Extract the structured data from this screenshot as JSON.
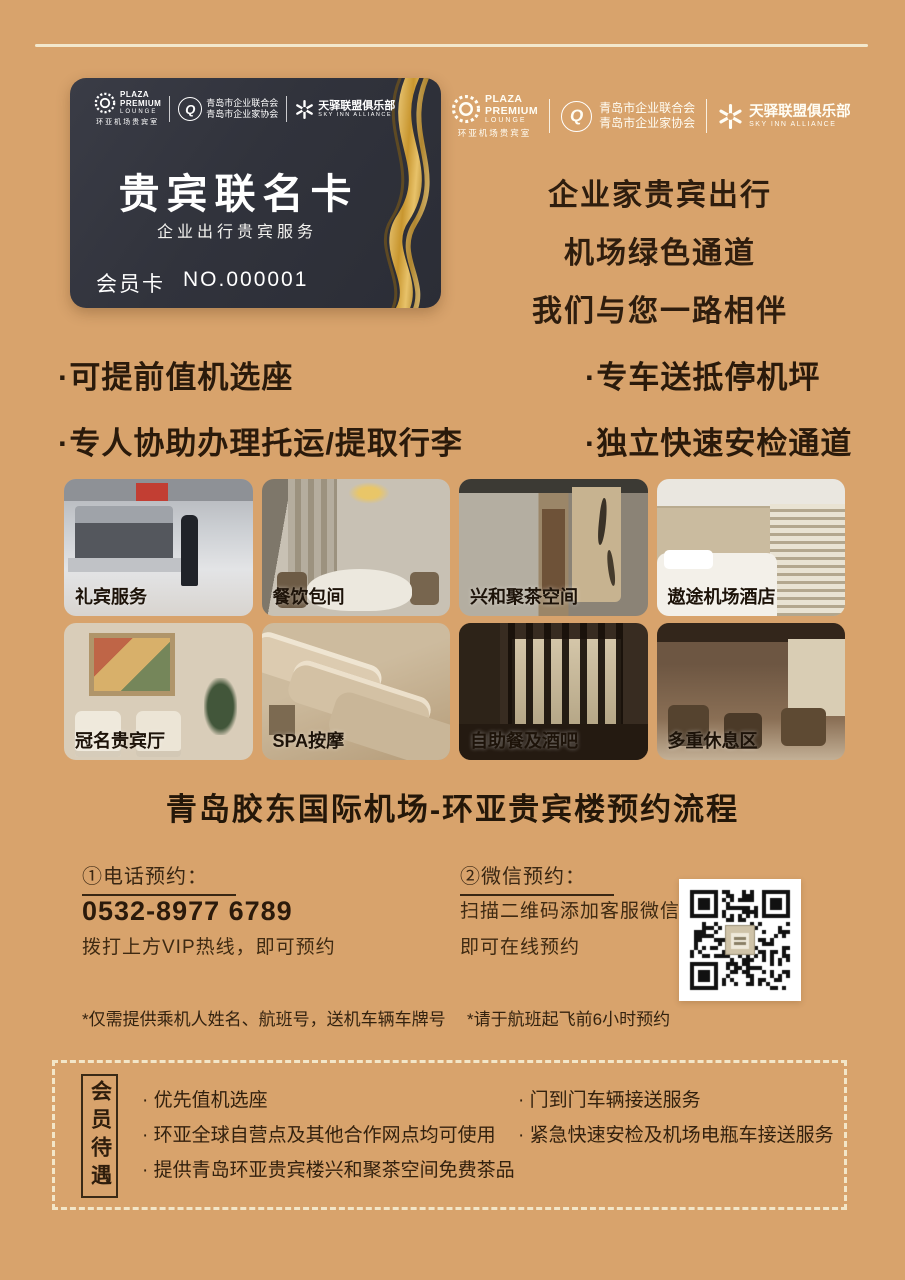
{
  "colors": {
    "background": "#d8a36c",
    "card_background": "#31333c",
    "gold_accent": "#d2a64f",
    "text_dark": "#2e1d0e",
    "line_cream": "#f3e8cd"
  },
  "logos": {
    "plaza": {
      "line1": "PLAZA",
      "line2": "PREMIUM",
      "line3": "LOUNGE",
      "sub": "环亚机场贵宾室"
    },
    "qingdao": {
      "initial": "Q",
      "line1": "青岛市企业联合会",
      "line2": "青岛市企业家协会"
    },
    "sky": {
      "line1": "天驿联盟俱乐部",
      "line2": "SKY INN ALLIANCE"
    }
  },
  "card": {
    "title": "贵宾联名卡",
    "subtitle": "企业出行贵宾服务",
    "member_label": "会员卡",
    "member_no": "NO.000001"
  },
  "slogan": {
    "line1": "企业家贵宾出行",
    "line2": "机场绿色通道",
    "line3": "我们与您一路相伴"
  },
  "features": {
    "left": [
      "·可提前值机选座",
      "·专人协助办理托运/提取行李"
    ],
    "right": [
      "·专车送抵停机坪",
      "·独立快速安检通道"
    ]
  },
  "gallery": [
    {
      "caption": "礼宾服务"
    },
    {
      "caption": "餐饮包间"
    },
    {
      "caption": "兴和聚茶空间"
    },
    {
      "caption": "遨途机场酒店"
    },
    {
      "caption": "冠名贵宾厅"
    },
    {
      "caption": "SPA按摩"
    },
    {
      "caption": "自助餐及酒吧"
    },
    {
      "caption": "多重休息区"
    }
  ],
  "section_title": "青岛胶东国际机场-环亚贵宾楼预约流程",
  "booking": {
    "phone": {
      "heading": "①电话预约：",
      "number": "0532-8977 6789",
      "note": "拨打上方VIP热线，即可预约"
    },
    "wechat": {
      "heading": "②微信预约：",
      "line1": "扫描二维码添加客服微信",
      "line2": "即可在线预约",
      "qr_label": "wechat-booking-qr"
    },
    "footnote_left": "*仅需提供乘机人姓名、航班号，送机车辆车牌号",
    "footnote_right": "*请于航班起飞前6小时预约"
  },
  "member_benefits": {
    "label": "会员待遇",
    "left": [
      "· 优先值机选座",
      "· 环亚全球自营点及其他合作网点均可使用",
      "· 提供青岛环亚贵宾楼兴和聚茶空间免费茶品"
    ],
    "right": [
      "· 门到门车辆接送服务",
      "· 紧急快速安检及机场电瓶车接送服务"
    ]
  }
}
